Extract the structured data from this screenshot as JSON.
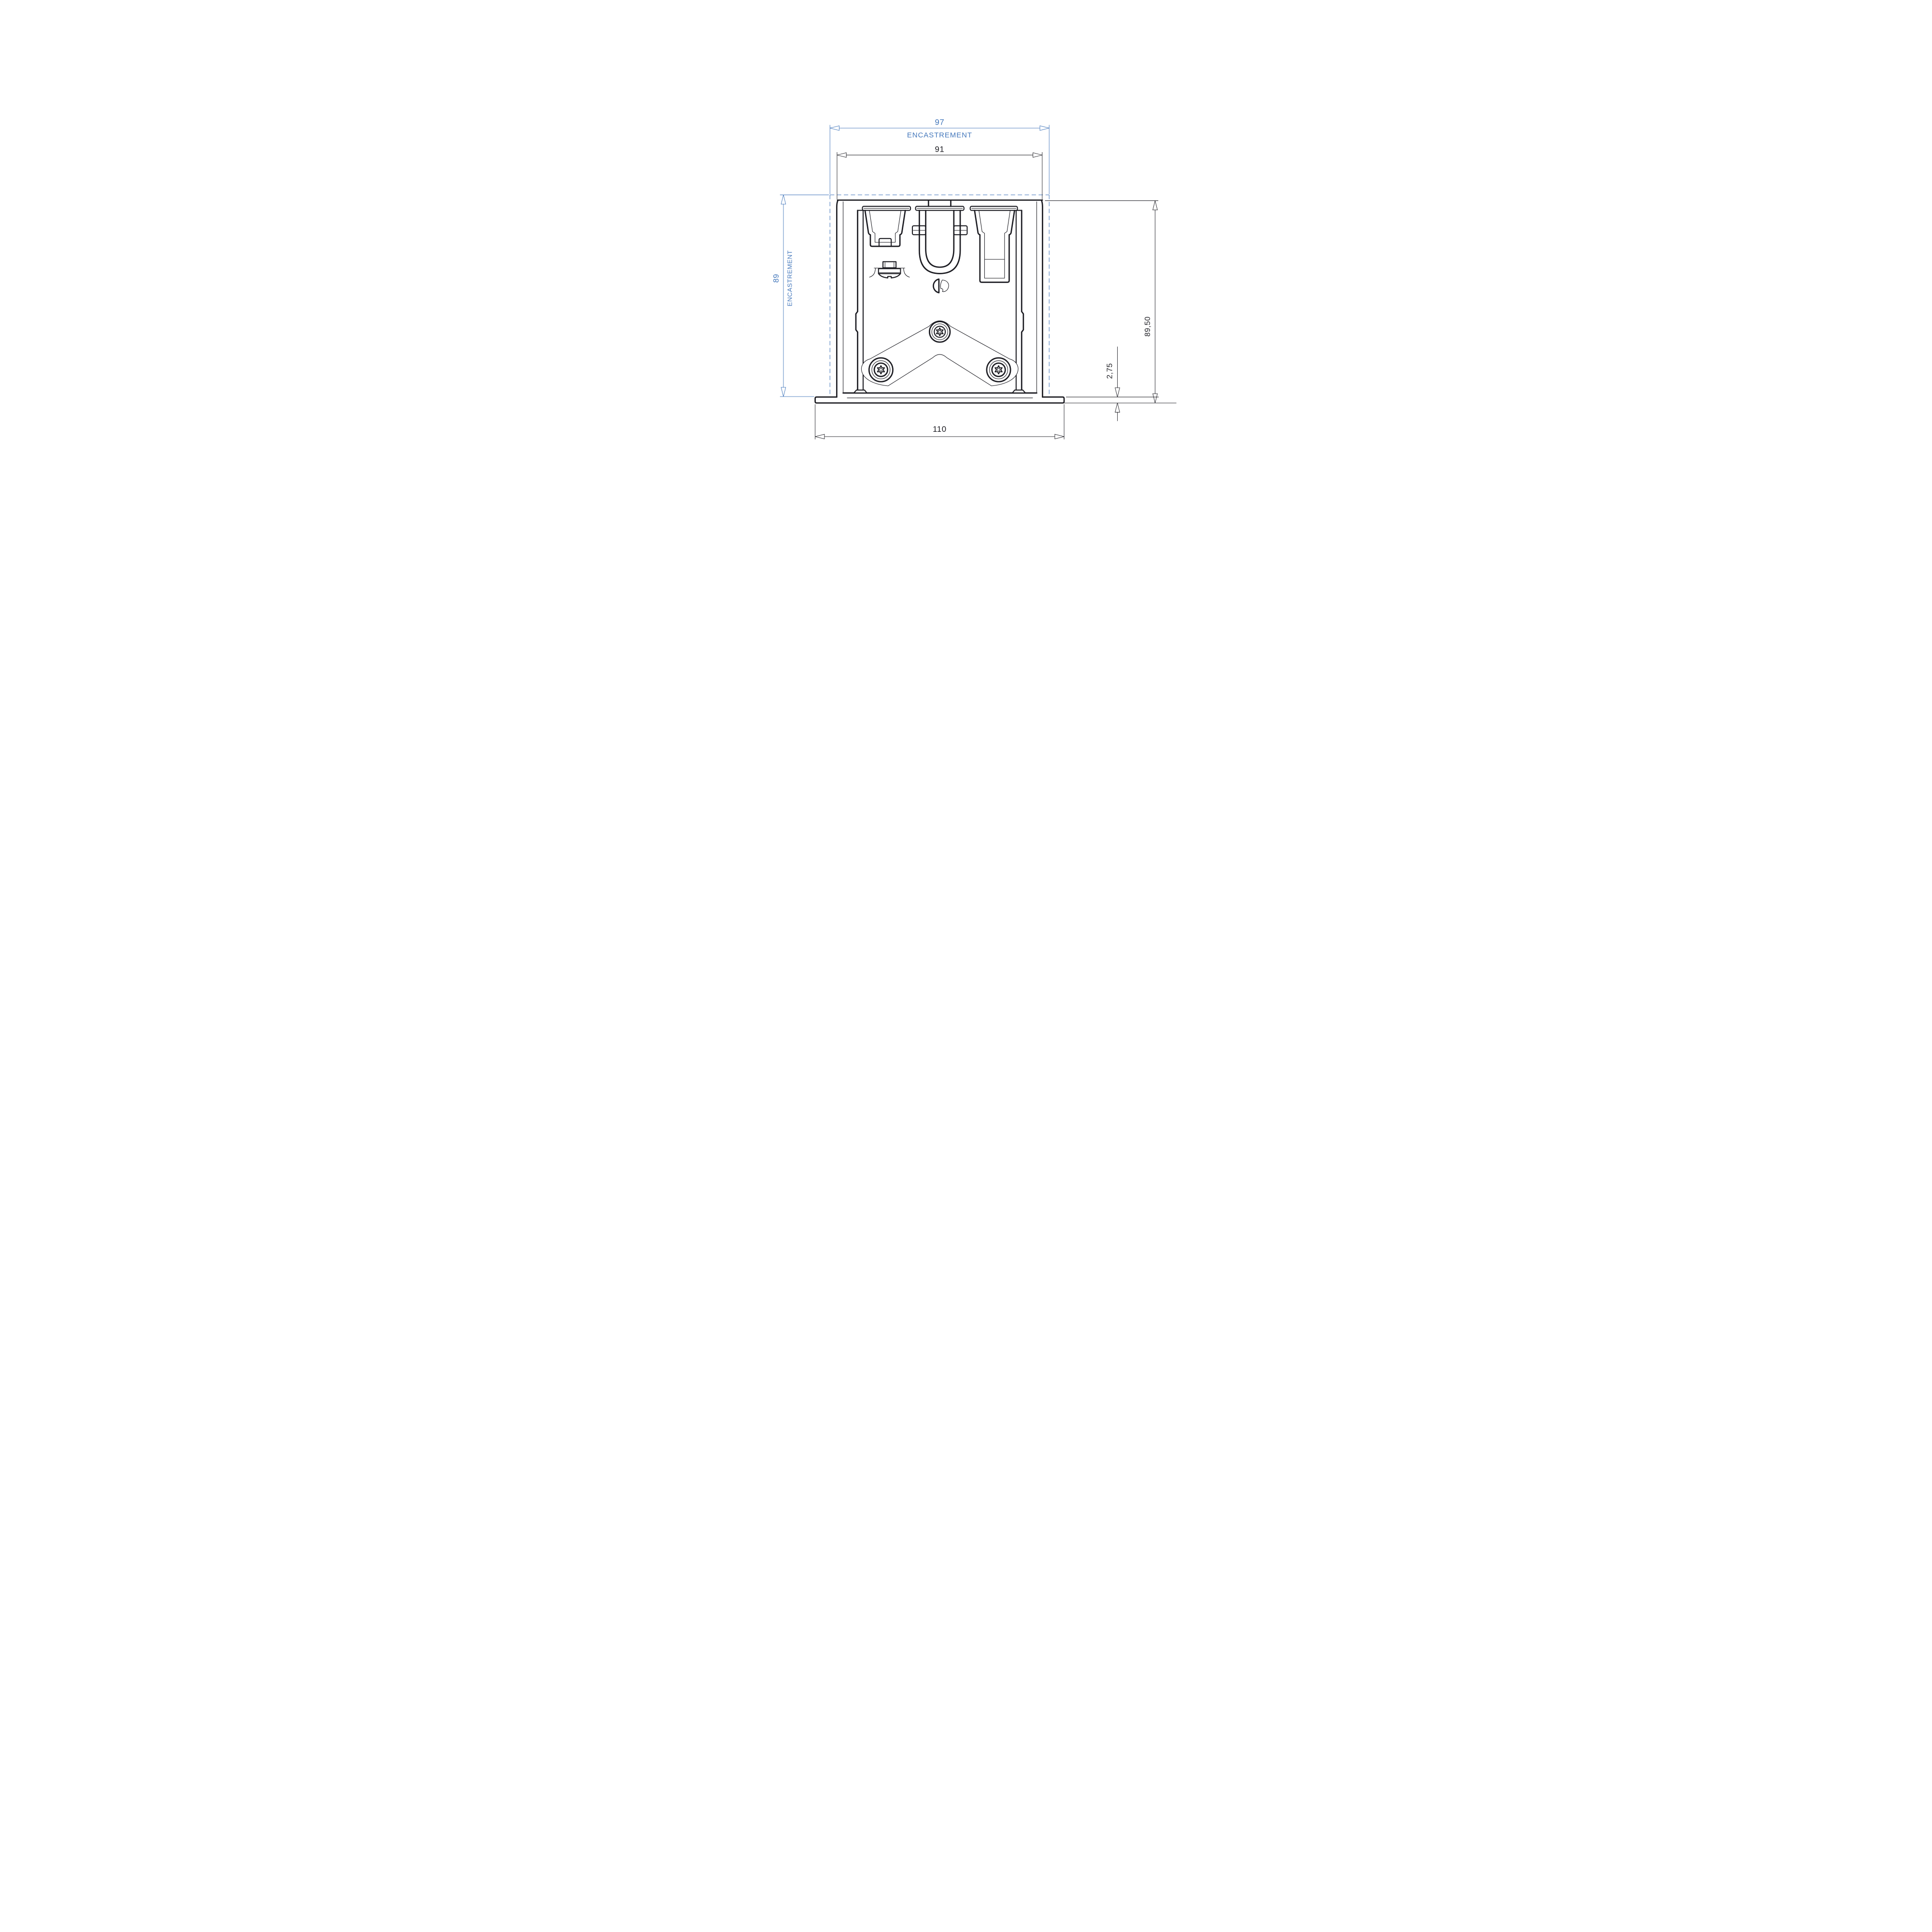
{
  "colors": {
    "accent": "#4377bb",
    "ink": "#1c1c22",
    "background": "#ffffff"
  },
  "dimensions": {
    "recess_width": {
      "value": "97",
      "label": "ENCASTREMENT"
    },
    "fixture_width": {
      "value": "91"
    },
    "recess_depth": {
      "value": "89",
      "label": "ENCASTREMENT"
    },
    "overall_height": {
      "value": "89,50"
    },
    "flange_thickness": {
      "value": "2,75"
    },
    "trim_width": {
      "value": "110"
    }
  }
}
